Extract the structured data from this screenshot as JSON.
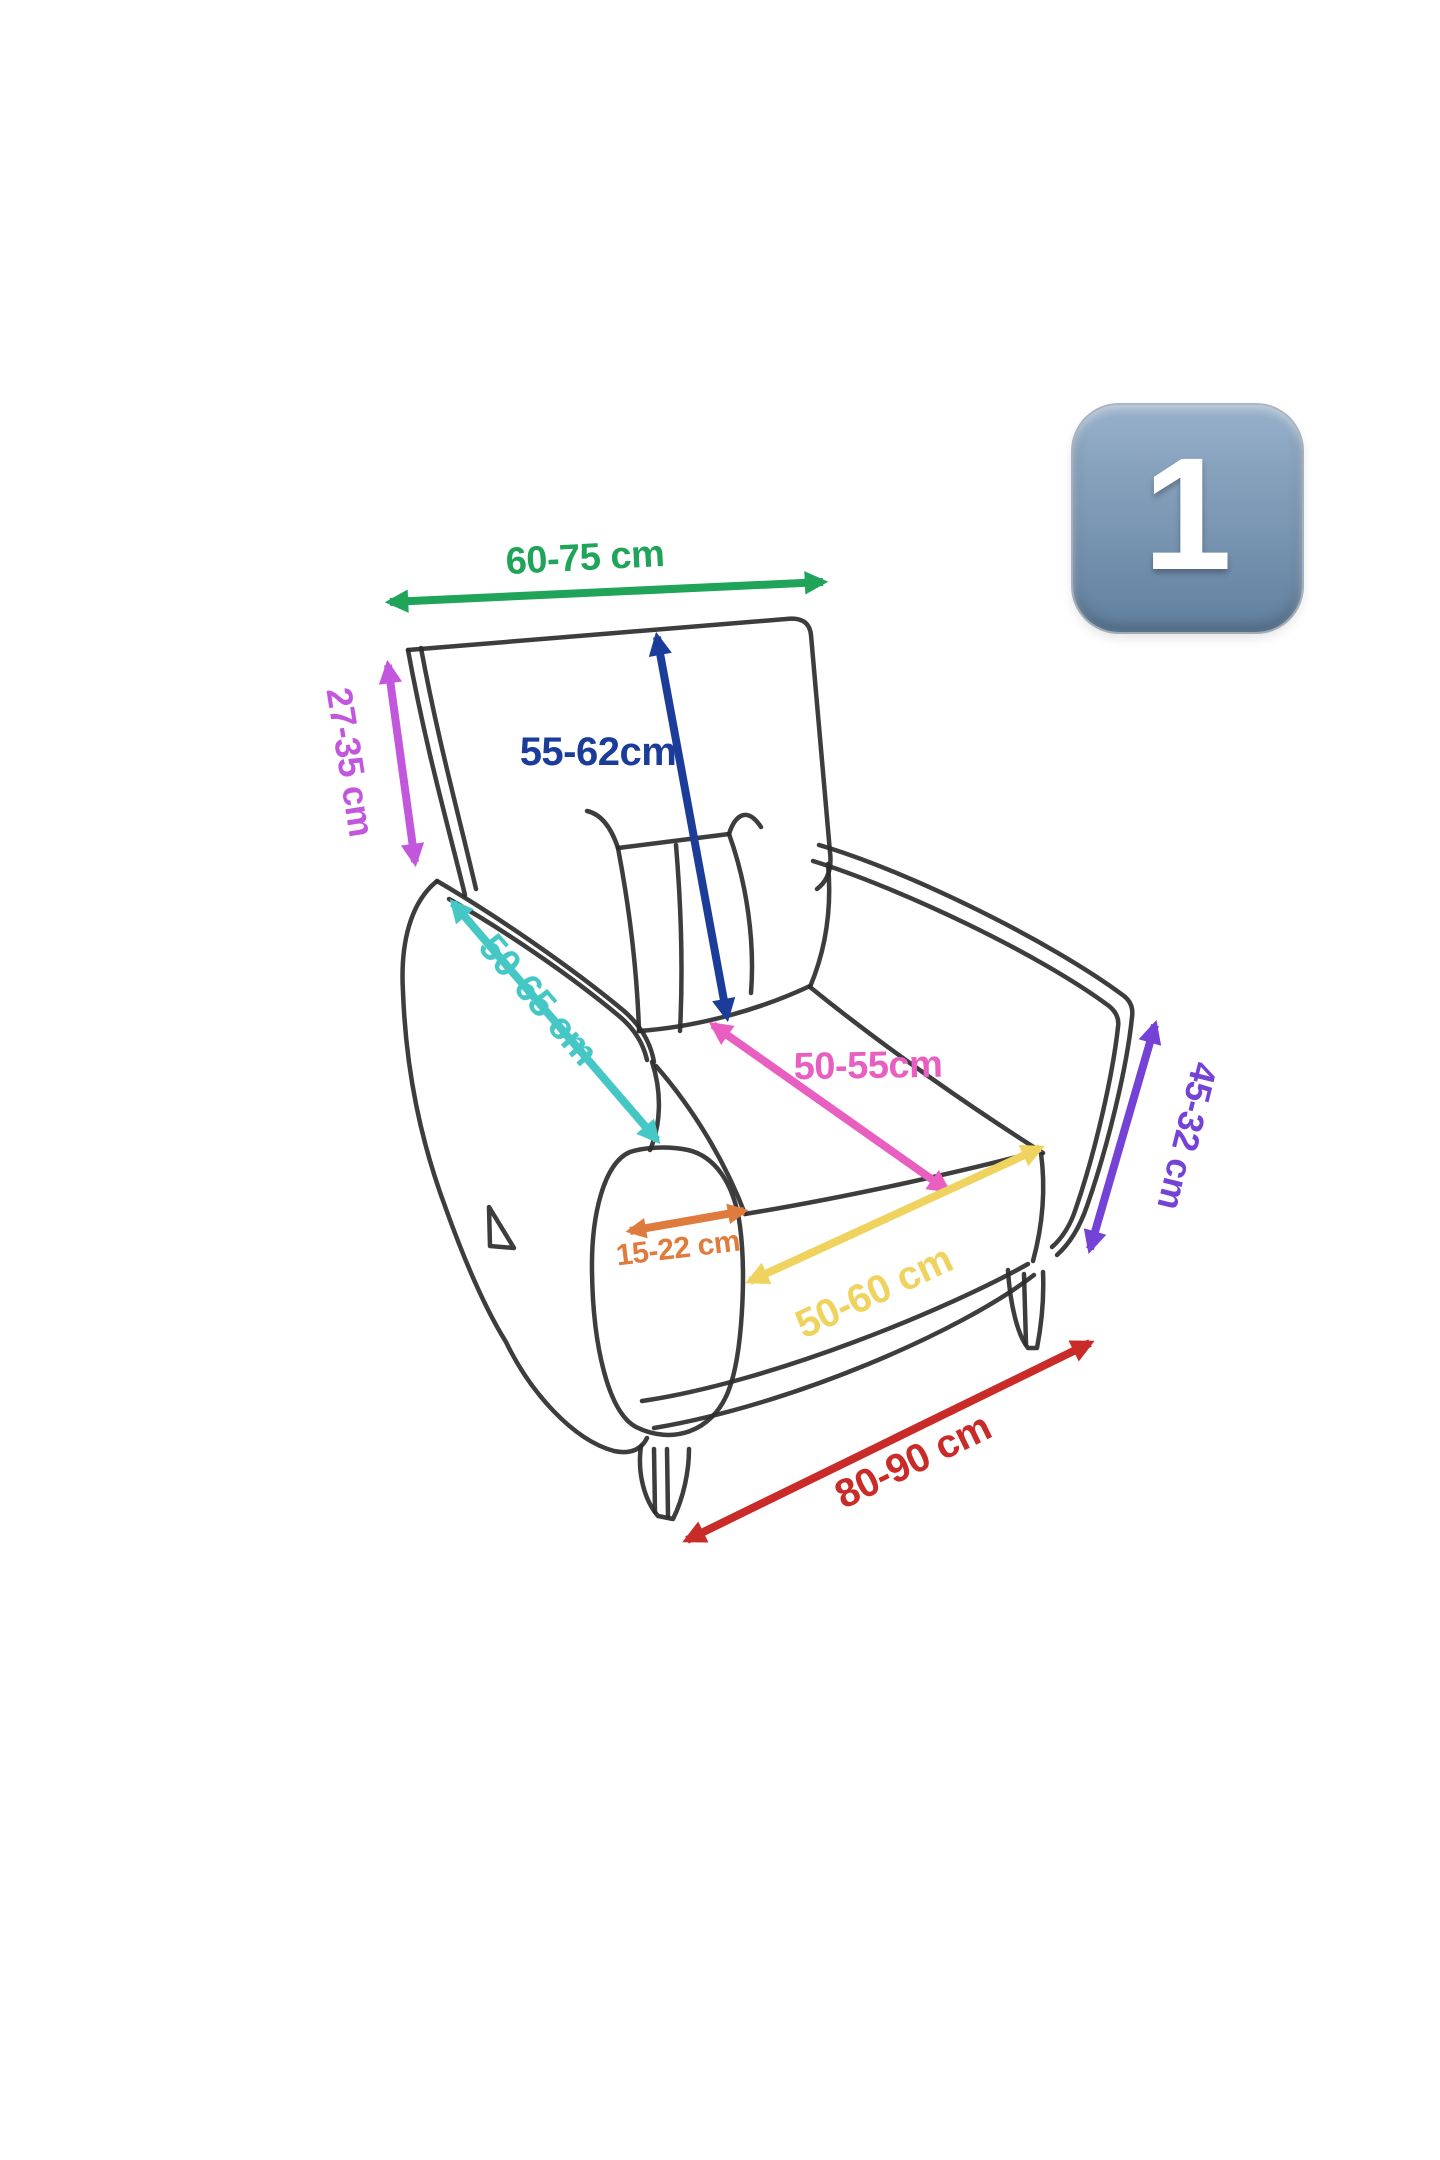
{
  "theme": {
    "canvas": "#FFFFFF",
    "sketch": "#2D2D2D",
    "badge-top": "#97B0CA",
    "badge-bottom": "#61809F",
    "badge-text": "#FFFFFF"
  },
  "badge": {
    "value": "1"
  },
  "diagram_subject": "Armchair measurement diagram",
  "measurements": [
    {
      "id": "back-top-width",
      "label": "60-75 cm",
      "color": "#1FA45A"
    },
    {
      "id": "back-side-height",
      "label": "27-35 cm",
      "color": "#C257DE"
    },
    {
      "id": "backrest-height",
      "label": "55-62cm",
      "color": "#1B3C99"
    },
    {
      "id": "armrest-length",
      "label": "50-65 cm",
      "color": "#45C8C5"
    },
    {
      "id": "seat-depth",
      "label": "50-55cm",
      "color": "#E85FC1"
    },
    {
      "id": "armrest-width",
      "label": "15-22 cm",
      "color": "#E07B3E"
    },
    {
      "id": "seat-front-width",
      "label": "50-60 cm",
      "color": "#EFD35E"
    },
    {
      "id": "side-front-height",
      "label": "45-32 cm",
      "color": "#7442D6"
    },
    {
      "id": "base-width",
      "label": "80-90 cm",
      "color": "#C92B28"
    }
  ]
}
